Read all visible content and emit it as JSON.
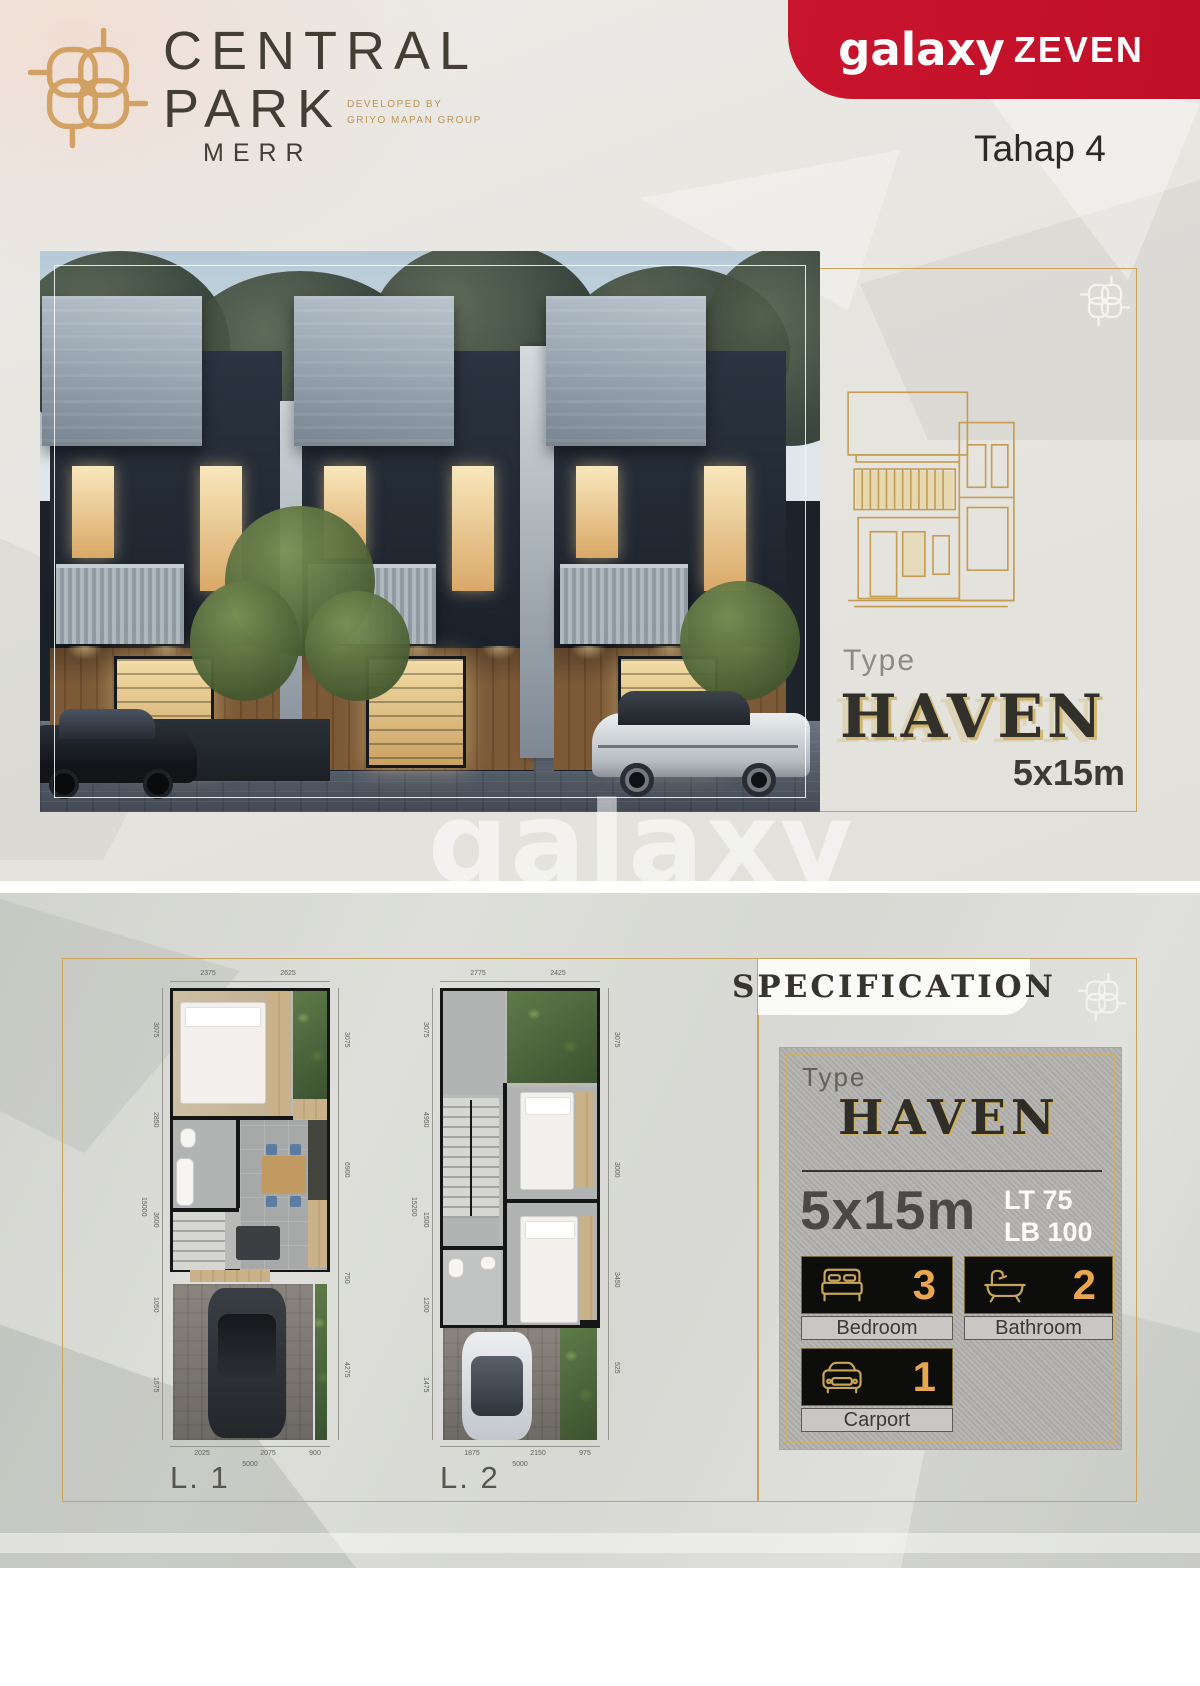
{
  "brand": {
    "line1": "CENTRAL",
    "line2": "PARK",
    "sub": "MERR",
    "developed_by": "DEVELOPED BY",
    "developer": "GRIYO MAPAN GROUP"
  },
  "header": {
    "galaxy": "galaxy",
    "zeven": "ZEVEN",
    "phase": "Tahap 4"
  },
  "hero": {
    "type_label": "Type",
    "type_name": "HAVEN",
    "size": "5x15m",
    "watermark": "galaxy"
  },
  "floorplans": {
    "l1": {
      "label": "L. 1",
      "top_dims": [
        "2375",
        "2625"
      ],
      "bottom_dims": [
        "2025",
        "2075",
        "900"
      ],
      "bottom_total": "5000",
      "left_dims": [
        "3075",
        "2850",
        "3600",
        "1050",
        "1575"
      ],
      "left_total": "15000",
      "right_dims": [
        "3075",
        "6900",
        "750",
        "4275"
      ]
    },
    "l2": {
      "label": "L. 2",
      "top_dims": [
        "2775",
        "2425"
      ],
      "bottom_dims": [
        "1875",
        "2150",
        "975"
      ],
      "bottom_total": "5000",
      "left_dims": [
        "3075",
        "4950",
        "1500",
        "1200",
        "1475"
      ],
      "left_total": "15200",
      "right_dims": [
        "3075",
        "3000",
        "3450",
        "525"
      ]
    }
  },
  "specification": {
    "title": "SPECIFICATION",
    "type_label": "Type",
    "type_name": "HAVEN",
    "size": "5x15m",
    "lt": "LT 75",
    "lb": "LB 100",
    "features": [
      {
        "icon": "bed-icon",
        "count": "3",
        "label": "Bedroom"
      },
      {
        "icon": "bathtub-icon",
        "count": "2",
        "label": "Bathroom"
      },
      {
        "icon": "car-icon",
        "count": "1",
        "label": "Carport"
      }
    ]
  },
  "colors": {
    "brand_gold": "#C9A456",
    "red": "#C6132C",
    "accent_number": "#E7A64F",
    "dark_text": "#3E3A33"
  }
}
